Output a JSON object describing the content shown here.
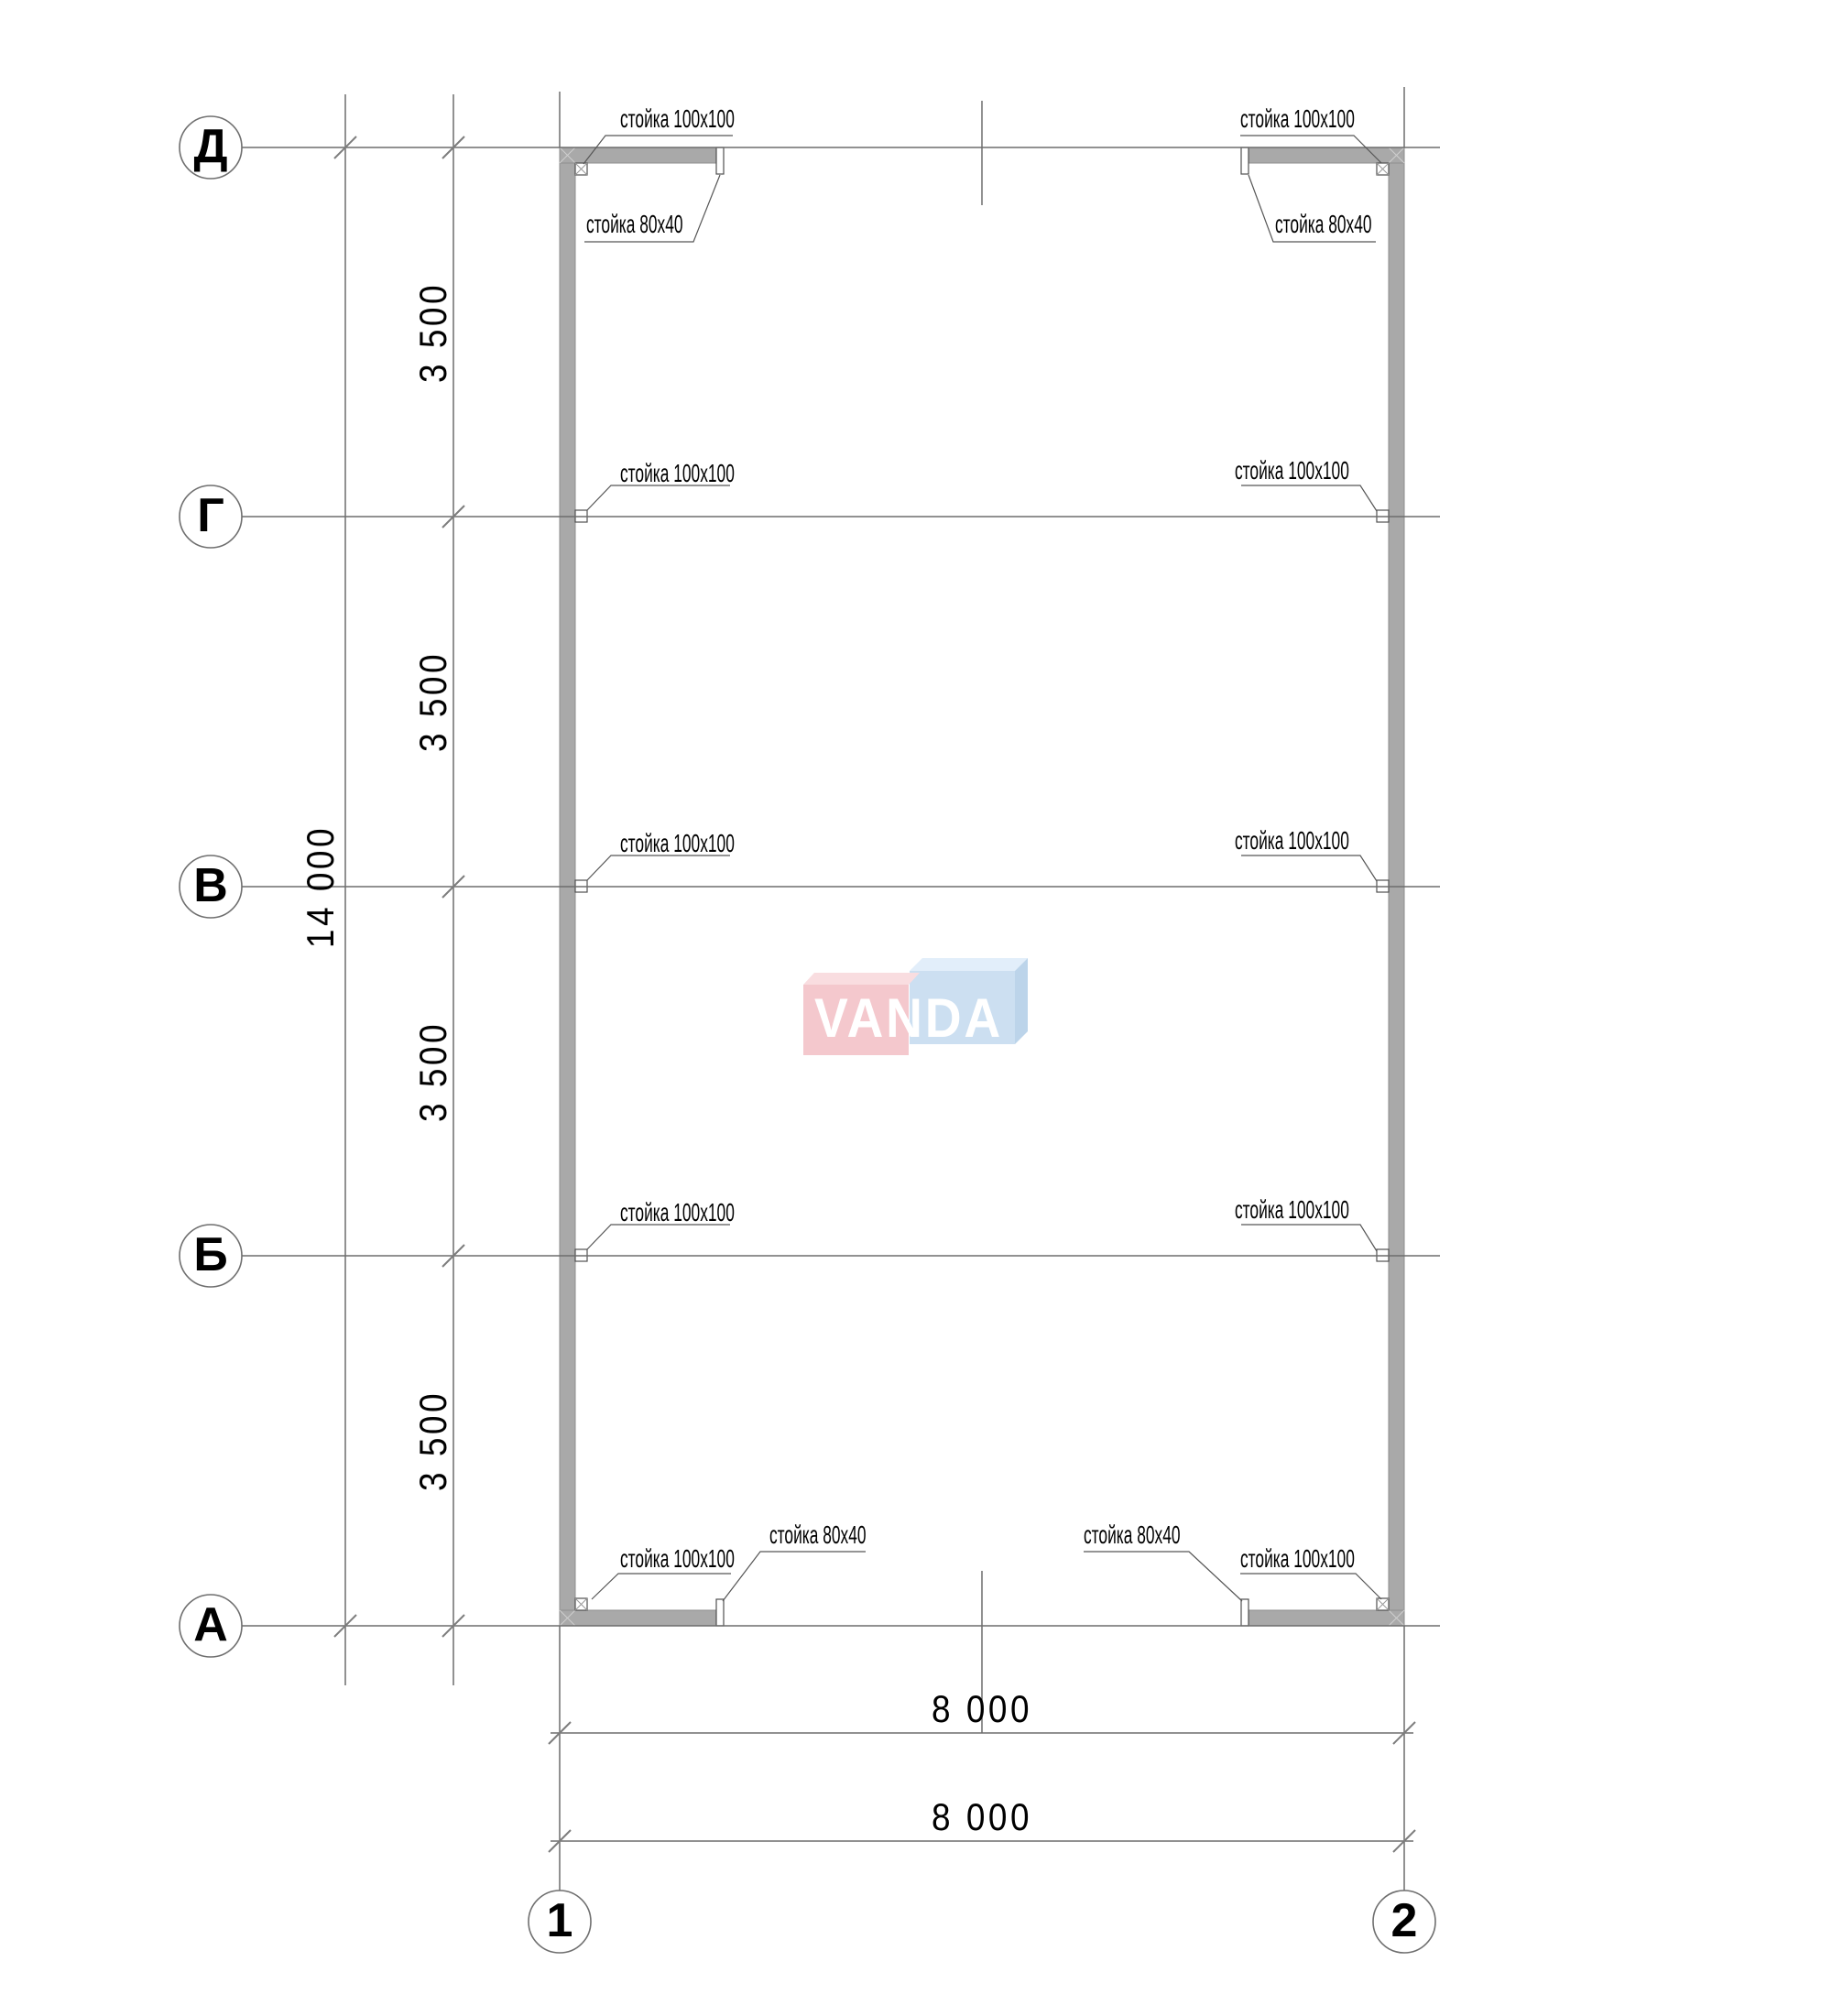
{
  "plan": {
    "row_axes": [
      "Д",
      "Г",
      "В",
      "Б",
      "А"
    ],
    "col_axes": [
      "1",
      "2"
    ],
    "dims": {
      "bay": "3 500",
      "total_height": "14 000",
      "width_top": "8 000",
      "width_bottom": "8 000"
    },
    "posts": {
      "corner_label": "стойка 100x100",
      "stub_label": "стойка 80x40"
    },
    "watermark": "VANDA",
    "colors": {
      "wall": "#a9a9a9",
      "axis_line": "#6d6d6d",
      "leader": "#565656",
      "logo_pink": "#f4c8cd",
      "logo_pink_top": "#f9dde0",
      "logo_blue": "#ccdff1",
      "logo_blue_top": "#e2eefa",
      "logo_blue_side": "#bcd4ea",
      "logo_text": "#ffffff"
    }
  }
}
